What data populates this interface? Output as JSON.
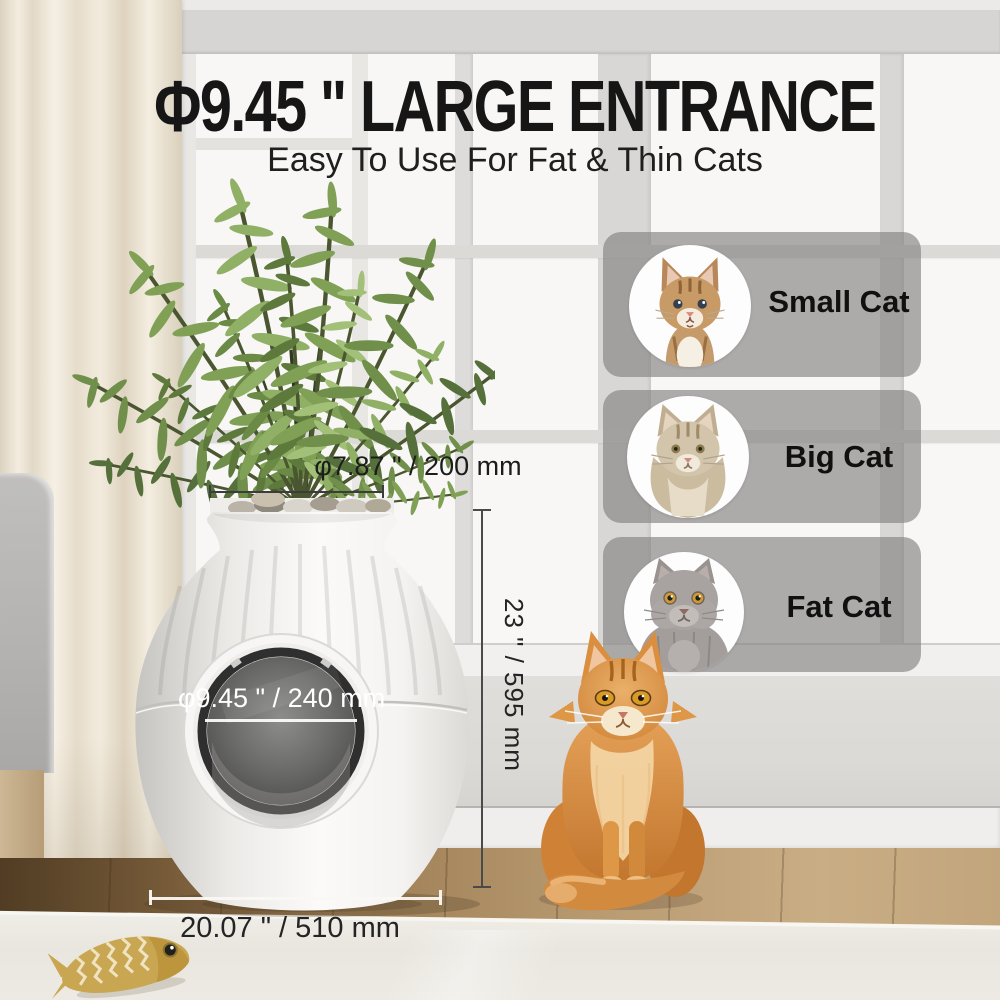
{
  "header": {
    "title": "Φ9.45 \" LARGE ENTRANCE",
    "subtitle": "Easy To Use For Fat & Thin Cats"
  },
  "annotations": {
    "top_opening": {
      "label": "φ7.87 \" / 200 mm"
    },
    "entrance": {
      "label": "φ9.45 \" / 240 mm"
    },
    "height": {
      "label": "23 \" / 595 mm"
    },
    "width": {
      "label": "20.07 \" / 510 mm"
    }
  },
  "size_cards": [
    {
      "label": "Small Cat",
      "icon": "kitten-photo"
    },
    {
      "label": "Big Cat",
      "icon": "big-cat-photo"
    },
    {
      "label": "Fat Cat",
      "icon": "fat-cat-photo"
    }
  ],
  "colors": {
    "headline_text": "#161616",
    "dimension_dark": "#3c3c3c",
    "dimension_light": "#ffffff",
    "card_overlay": "rgba(134,132,130,0.66)"
  }
}
